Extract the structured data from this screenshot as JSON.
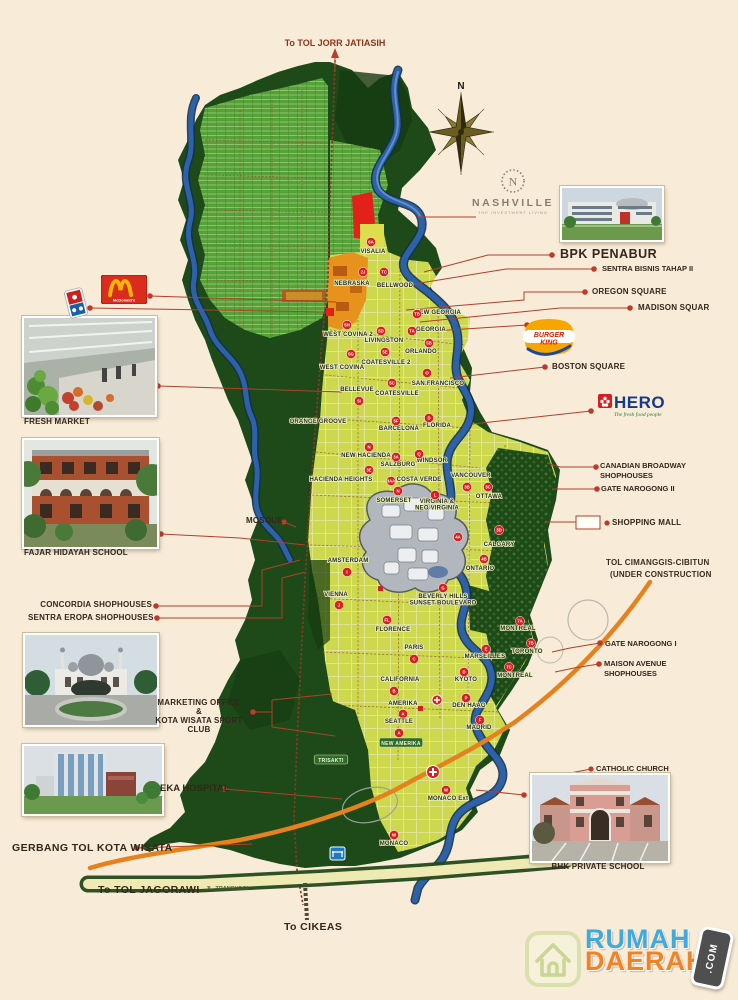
{
  "page": {
    "background": "#f8ecd9"
  },
  "top": {
    "exit_label": "To TOL JORR JATIASIH"
  },
  "compass": {
    "north": "N"
  },
  "nashville": {
    "initial": "N",
    "name": "NASHVILLE",
    "tagline": "THE INVESTMENT LIVING"
  },
  "brands": {
    "mcdonalds": {
      "name": "McDonald's"
    },
    "dominos": {
      "name": "Domino's Pizza"
    },
    "burger_king": {
      "line1": "BURGER",
      "line2": "KING"
    },
    "hero": {
      "name": "HERO",
      "tagline": "The fresh food people"
    }
  },
  "callouts": {
    "left": {
      "fresh_market": "FRESH MARKET",
      "fajar_school": "FAJAR HIDAYAH SCHOOL",
      "mosque": "MOSQUE",
      "concordia": "CONCORDIA SHOPHOUSES",
      "sentra_eropa": "SENTRA EROPA SHOPHOUSES",
      "marketing_line1": "MARKETING OFFICE",
      "marketing_amp": "&",
      "marketing_line2": "KOTA WISATA SPORT CLUB",
      "eka_hospital": "EKA HOSPITAL",
      "gerbang_tol": "GERBANG TOL KOTA WISATA"
    },
    "right": {
      "bpk_penabur": "BPK PENABUR",
      "sentra_bisnis": "SENTRA BISNIS TAHAP II",
      "oregon": "OREGON SQUARE",
      "madison": "MADISON SQUAR",
      "boston": "BOSTON SQUARE",
      "canadian_1": "CANADIAN BROADWAY",
      "canadian_2": "SHOPHOUSES",
      "gate_narogong_2": "GATE NAROGONG II",
      "shopping_mall": "SHOPPING MALL",
      "tol_cimanggis_1": "TOL CIMANGGIS-CIBITUN",
      "tol_cimanggis_2": "(UNDER CONSTRUCTION",
      "gate_narogong_1": "GATE NAROGONG I",
      "maison_1": "MAISON AVENUE",
      "maison_2": "SHOPHOUSES",
      "catholic_church": "CATHOLIC CHURCH",
      "bhk_school": "BHK PRIVATE SCHOOL"
    }
  },
  "roads": {
    "jl_transyogi": "JL. TRANSYOGI",
    "to_cikeas": "To CIKEAS",
    "to_jagorawi": "To TOL JAGORAWI"
  },
  "footer_logo": {
    "word1": "RUMAH",
    "word2": "DAERAH",
    "badge": ".COM"
  },
  "map": {
    "colors": {
      "forest": "#1e4a19",
      "residential": "#55a238",
      "district": "#cdd84f",
      "commercial": "#e6921c",
      "parcel_red": "#e32019",
      "river": "#2e62a8",
      "badge": "#d91f1f",
      "highway_construction": "#e5821e"
    },
    "districts": [
      {
        "label": "VISALIA",
        "x": 373,
        "y": 253,
        "badge": "6A",
        "bx": 371,
        "by": 242
      },
      {
        "label": "NEBRASKA",
        "x": 352,
        "y": 285,
        "badge": "2J",
        "bx": 363,
        "by": 272
      },
      {
        "label": "BELLWOOD",
        "x": 395,
        "y": 287,
        "badge": "TC",
        "bx": 384,
        "by": 272
      },
      {
        "label": "NEW GEORGIA",
        "x": 438,
        "y": 314,
        "badge": "TB",
        "bx": 417,
        "by": 314
      },
      {
        "label": "GEORGIA",
        "x": 431,
        "y": 331,
        "badge": "TA",
        "bx": 412,
        "by": 331
      },
      {
        "label": "WEST COVINA 2",
        "x": 348,
        "y": 336,
        "badge": "5H",
        "bx": 347,
        "by": 325
      },
      {
        "label": "LIVINGSTON",
        "x": 384,
        "y": 342,
        "badge": "5D",
        "bx": 381,
        "by": 331
      },
      {
        "label": "ORLANDO",
        "x": 421,
        "y": 353,
        "badge": "5B",
        "bx": 429,
        "by": 343
      },
      {
        "label": "COATESVILLE 2",
        "x": 386,
        "y": 364,
        "badge": "5E",
        "bx": 385,
        "by": 352
      },
      {
        "label": "WEST COVINA",
        "x": 342,
        "y": 369,
        "badge": "5G",
        "bx": 351,
        "by": 354
      },
      {
        "label": "SAN FRANCISCO",
        "x": 438,
        "y": 385,
        "badge": "O",
        "bx": 427,
        "by": 373
      },
      {
        "label": "BELLEVUE",
        "x": 357,
        "y": 391,
        "badge": "5I",
        "bx": 359,
        "by": 401
      },
      {
        "label": "COATESVILLE",
        "x": 397,
        "y": 395,
        "badge": "5C",
        "bx": 392,
        "by": 383
      },
      {
        "label": "ORANGE GROOVE",
        "x": 318,
        "y": 423
      },
      {
        "label": "BARCELONA",
        "x": 399,
        "y": 430,
        "badge": "5F",
        "bx": 396,
        "by": 421
      },
      {
        "label": "FLORIDA",
        "x": 437,
        "y": 427,
        "badge": "D",
        "bx": 429,
        "by": 418
      },
      {
        "label": "NEW HACIENDA",
        "x": 366,
        "y": 457,
        "badge": "N",
        "bx": 369,
        "by": 447
      },
      {
        "label": "SALZBURG",
        "x": 398,
        "y": 466,
        "badge": "3A",
        "bx": 396,
        "by": 457
      },
      {
        "label": "WINDSOR",
        "x": 432,
        "y": 462,
        "badge": "Q",
        "bx": 419,
        "by": 454
      },
      {
        "label": "HACIENDA HEIGHTS",
        "x": 341,
        "y": 481,
        "badge": "3E",
        "bx": 369,
        "by": 470
      },
      {
        "label": "COSTA VERDE",
        "x": 419,
        "y": 481,
        "badge": "3AA",
        "bx": 391,
        "by": 481
      },
      {
        "label": "VANCOUVER",
        "x": 471,
        "y": 477,
        "badge": "3B",
        "bx": 467,
        "by": 487
      },
      {
        "label": "SOMERSET",
        "x": 394,
        "y": 502,
        "badge": "N",
        "bx": 398,
        "by": 491
      },
      {
        "label": "OTTAWA",
        "x": 489,
        "y": 498,
        "badge": "3C",
        "bx": 488,
        "by": 487
      },
      {
        "label": "VIRGINIA &|NEO VIRGINIA",
        "x": 437,
        "y": 506,
        "badge": "L",
        "bx": 435,
        "by": 495
      },
      {
        "label": "CALGARY",
        "x": 499,
        "y": 546,
        "badge": "3D",
        "bx": 499,
        "by": 530
      },
      {
        "label": "ONTARIO",
        "x": 480,
        "y": 570,
        "badge": "4B",
        "bx": 484,
        "by": 559
      },
      {
        "label": "AMSTERDAM",
        "x": 348,
        "y": 562,
        "badge": "I",
        "bx": 347,
        "by": 572
      },
      {
        "label": "VIENNA",
        "x": 336,
        "y": 596,
        "badge": "J",
        "bx": 339,
        "by": 605
      },
      {
        "label": "BEVERLY HILLS|SUNSET BOULEVARD",
        "x": 443,
        "y": 601,
        "badge": "G",
        "bx": 443,
        "by": 588
      },
      {
        "label": "FLORENCE",
        "x": 393,
        "y": 631,
        "badge": "FL",
        "bx": 387,
        "by": 620
      },
      {
        "label": "PARIS",
        "x": 414,
        "y": 649,
        "badge": "C",
        "bx": 414,
        "by": 659
      },
      {
        "label": "MONTREAL",
        "x": 518,
        "y": 630,
        "badge": "7A",
        "bx": 520,
        "by": 621
      },
      {
        "label": "TORONTO",
        "x": 527,
        "y": 653,
        "badge": "7B",
        "bx": 531,
        "by": 643
      },
      {
        "label": "MARSEILLES",
        "x": 485,
        "y": 658,
        "badge": "E",
        "bx": 486,
        "by": 649
      },
      {
        "label": "MONTREAL",
        "x": 515,
        "y": 677,
        "badge": "7C",
        "bx": 509,
        "by": 667
      },
      {
        "label": "KYOTO",
        "x": 466,
        "y": 681,
        "badge": "D",
        "bx": 464,
        "by": 672
      },
      {
        "label": "CALIFORNIA",
        "x": 400,
        "y": 681,
        "badge": "B",
        "bx": 394,
        "by": 691
      },
      {
        "label": "AMERIKA",
        "x": 403,
        "y": 705,
        "badge": "A",
        "bx": 403,
        "by": 714
      },
      {
        "label": "DEN HAAG",
        "x": 469,
        "y": 707,
        "badge": "P",
        "bx": 466,
        "by": 698
      },
      {
        "label": "SEATTLE",
        "x": 399,
        "y": 723,
        "badge": "A",
        "bx": 399,
        "by": 733
      },
      {
        "label": "MADRID",
        "x": 479,
        "y": 729,
        "badge": "F",
        "bx": 480,
        "by": 720
      },
      {
        "label": "NEW AMERIKA",
        "x": 401,
        "y": 743,
        "type": "pill"
      },
      {
        "label": "TRISAKTI",
        "x": 331,
        "y": 760,
        "type": "pill"
      },
      {
        "label": "MONACO Ext",
        "x": 448,
        "y": 800,
        "badge": "W",
        "bx": 446,
        "by": 790
      },
      {
        "label": "MONACO",
        "x": 394,
        "y": 845,
        "badge": "W",
        "bx": 394,
        "by": 835
      }
    ],
    "extra_badges": [
      {
        "badge": "4A",
        "bx": 458,
        "by": 537
      }
    ]
  }
}
